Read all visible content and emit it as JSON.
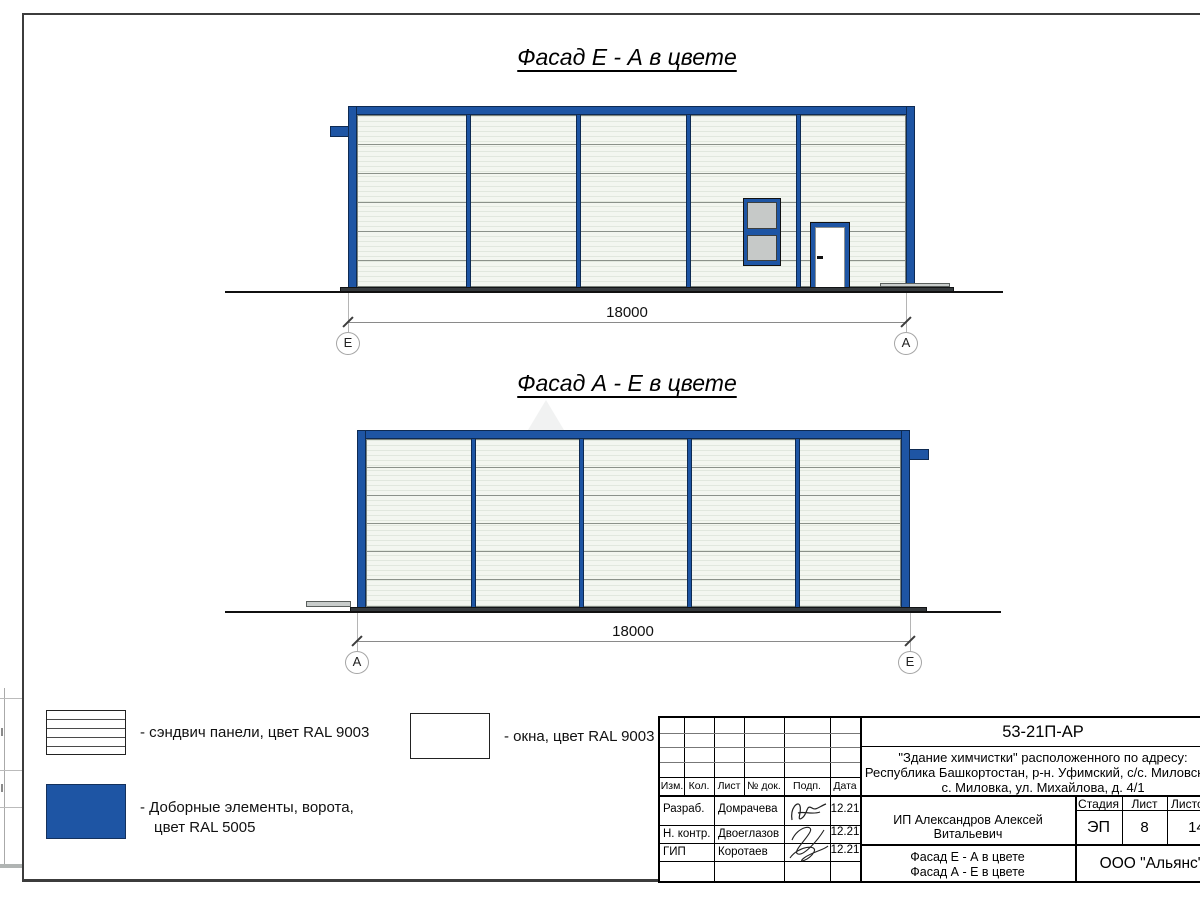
{
  "facade_top": {
    "title": "Фасад Е - А в цвете",
    "dim": "18000",
    "marker_left": "Е",
    "marker_right": "А"
  },
  "facade_bottom": {
    "title": "Фасад А - Е в цвете",
    "dim": "18000",
    "marker_left": "А",
    "marker_right": "Е"
  },
  "legend": {
    "sandwich_label": "- сэндвич панели, цвет RAL 9003",
    "windows_label": "- окна, цвет RAL 9003",
    "extras_label_line1": "- Доборные элементы, ворота,",
    "extras_label_line2": "цвет RAL 5005"
  },
  "colors": {
    "ral5005_blue": "#1e55a4",
    "ral9003_panel": "#f3f6f0",
    "glass_gray": "#c6c9c8",
    "base_dark": "#35393c"
  },
  "titleblock": {
    "doc_code": "53-21П-АР",
    "address_line1": "\"Здание химчистки\" расположенного по адресу:",
    "address_line2": "Республика Башкортостан, р-н. Уфимский, с/с. Миловский,",
    "address_line3": "с. Миловка, ул. Михайлова, д. 4/1",
    "col_izm": "Изм.",
    "col_kol": "Кол.",
    "col_list": "Лист",
    "col_doc": "№ док.",
    "col_podp": "Подп.",
    "col_data": "Дата",
    "rows": [
      {
        "role": "Разраб.",
        "name": "Домрачева",
        "date": "12.21"
      },
      {
        "role": "Н. контр.",
        "name": "Двоеглазов",
        "date": "12.21"
      },
      {
        "role": "ГИП",
        "name": "Коротаев",
        "date": "12.21"
      }
    ],
    "client": "ИП Александров Алексей Витальевич",
    "stage_label": "Стадия",
    "sheet_label": "Лист",
    "sheets_label": "Листов",
    "stage_value": "ЭП",
    "sheet_value": "8",
    "sheets_value": "14",
    "drawing_title_line1": "Фасад Е - А в цвете",
    "drawing_title_line2": "Фасад А - Е в цвете",
    "company": "ООО \"Альянс\""
  }
}
